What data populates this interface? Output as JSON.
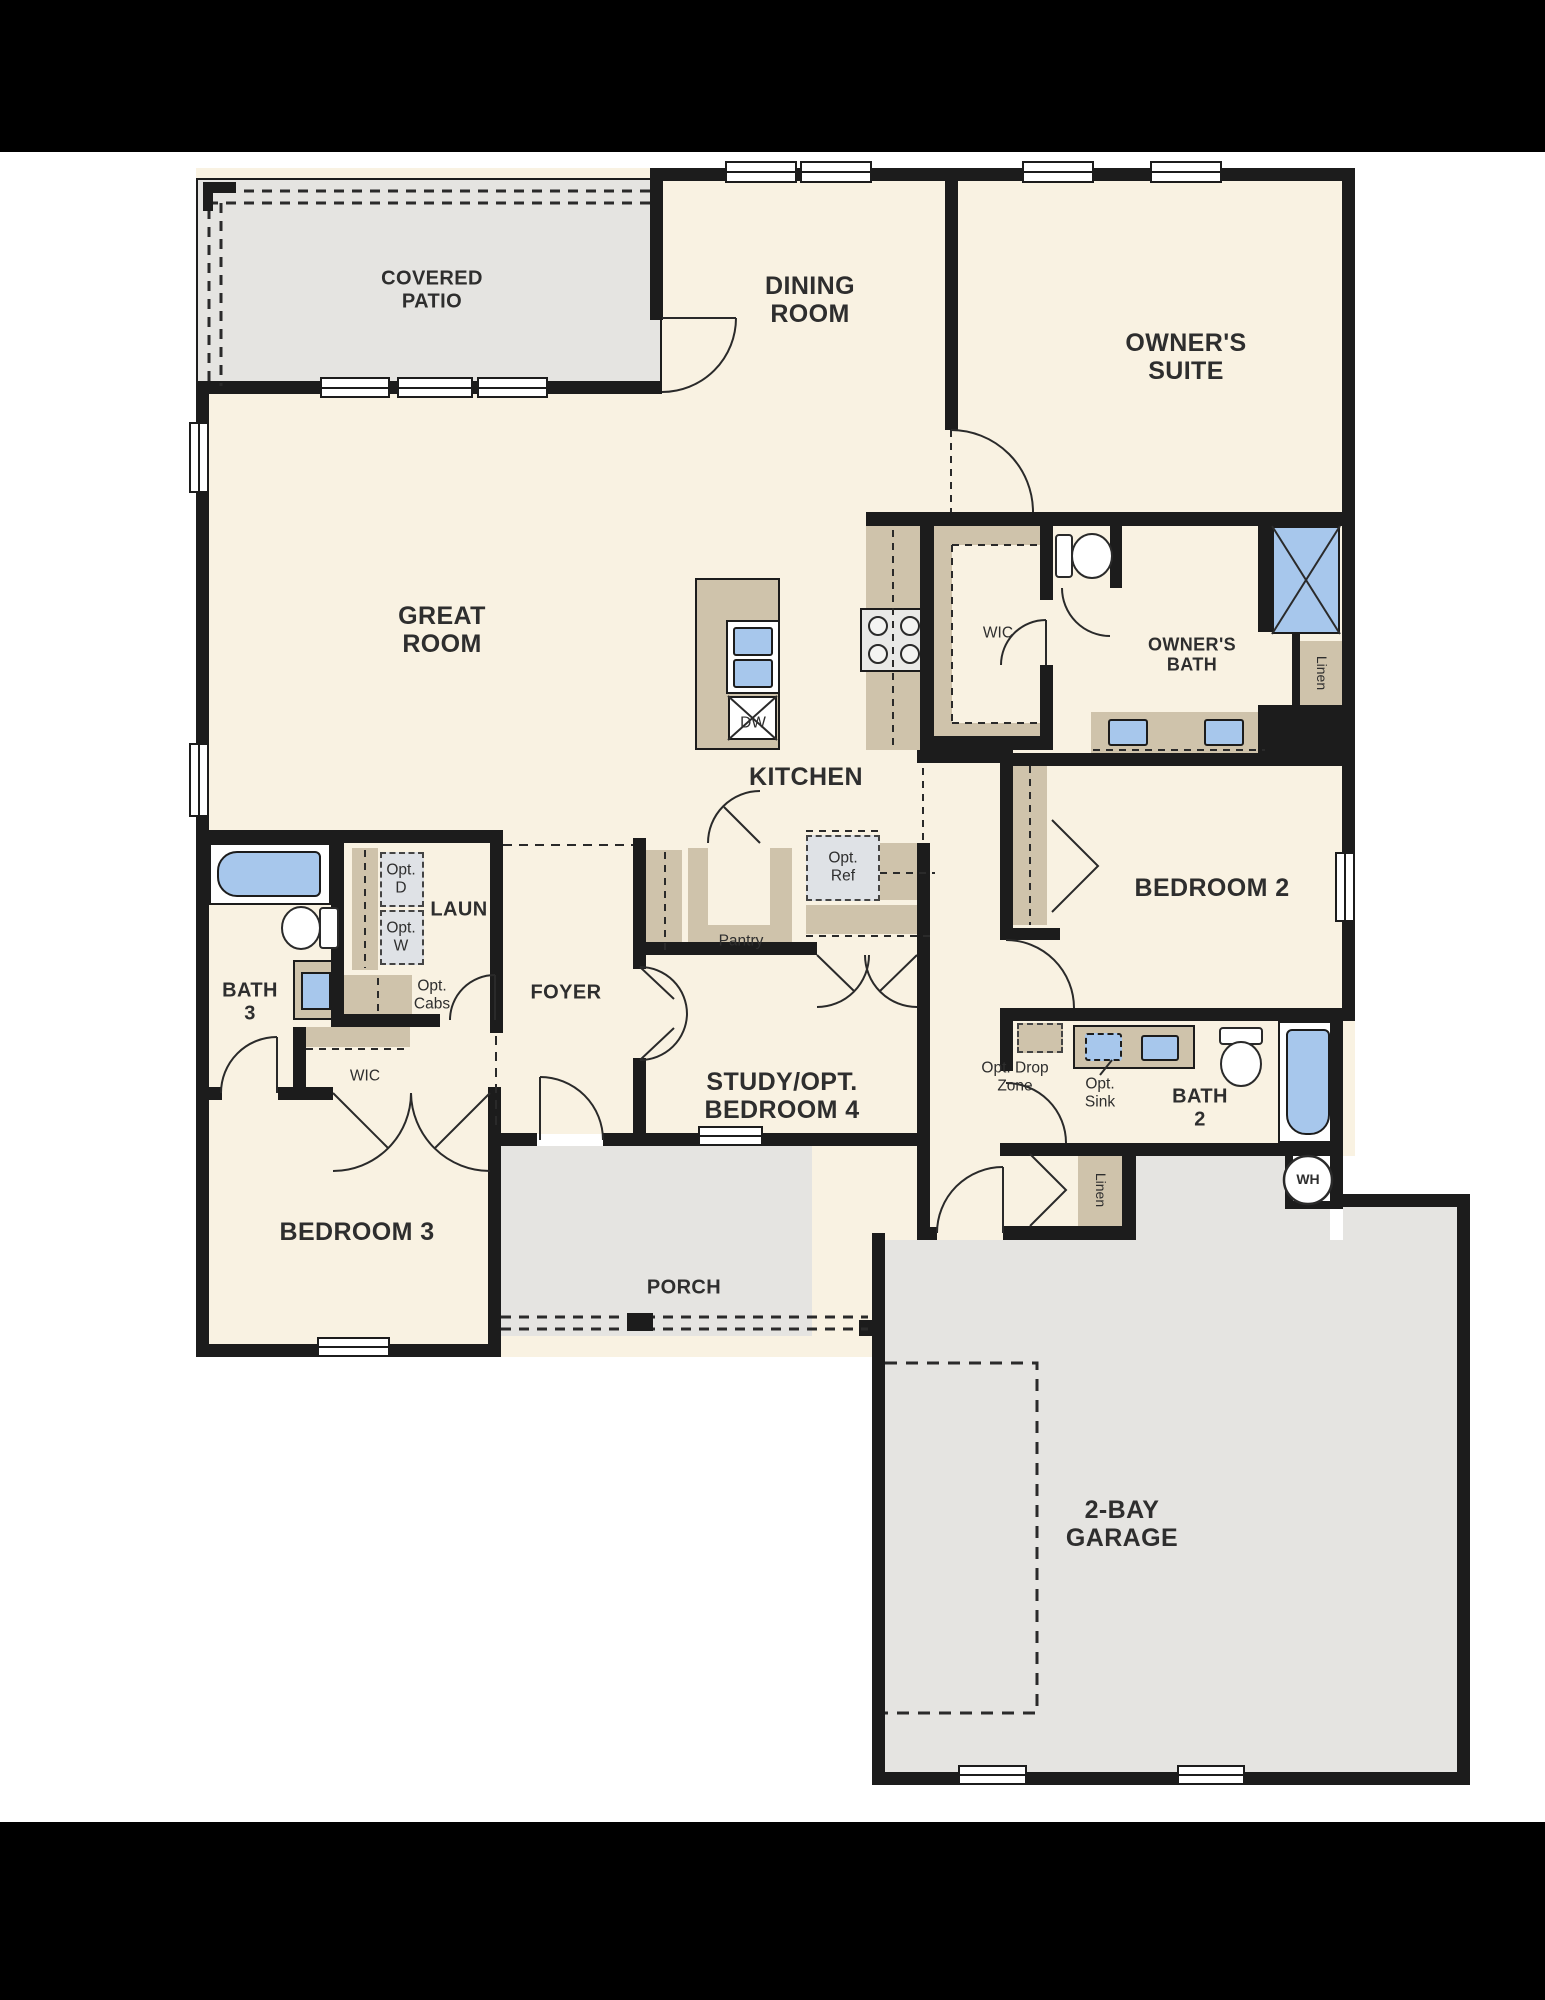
{
  "title": "Single-story home floor plan",
  "palette": {
    "background": "#000000",
    "paper": "#ffffff",
    "floor_cream": "#f9f2e2",
    "outdoor_gray": "#e5e4e1",
    "cabinet_tan": "#cfc3ab",
    "fixture_blue": "#a7c7ec",
    "optional_gray": "#dfe2e6",
    "wall_black": "#1c1c1c",
    "text": "#2e2e2e"
  },
  "labels": {
    "covered_patio": {
      "text": "COVERED\nPATIO"
    },
    "dining": {
      "text": "DINING\nROOM"
    },
    "owners_suite": {
      "text": "OWNER'S\nSUITE"
    },
    "great_room": {
      "text": "GREAT\nROOM"
    },
    "kitchen": {
      "text": "KITCHEN"
    },
    "wic_owner": {
      "text": "WIC"
    },
    "owners_bath": {
      "text": "OWNER'S\nBATH"
    },
    "linen_owner": {
      "text": "Linen"
    },
    "bedroom2": {
      "text": "BEDROOM 2"
    },
    "bath3": {
      "text": "BATH\n3"
    },
    "laun": {
      "text": "LAUN"
    },
    "opt_d": {
      "text": "Opt.\nD"
    },
    "opt_w": {
      "text": "Opt.\nW"
    },
    "opt_cabs": {
      "text": "Opt.\nCabs"
    },
    "foyer": {
      "text": "FOYER"
    },
    "pantry": {
      "text": "Pantry"
    },
    "opt_ref": {
      "text": "Opt.\nRef"
    },
    "study": {
      "text": "STUDY/OPT.\nBEDROOM 4"
    },
    "wic_bed3": {
      "text": "WIC"
    },
    "bedroom3": {
      "text": "BEDROOM 3"
    },
    "porch": {
      "text": "PORCH"
    },
    "opt_drop_zone": {
      "text": "Opt. Drop\nZone"
    },
    "opt_sink": {
      "text": "Opt.\nSink"
    },
    "bath2": {
      "text": "BATH\n2"
    },
    "linen_hall": {
      "text": "Linen"
    },
    "water_heater": {
      "text": "WH"
    },
    "dishwasher": {
      "text": "DW"
    },
    "garage": {
      "text": "2-BAY\nGARAGE"
    }
  }
}
